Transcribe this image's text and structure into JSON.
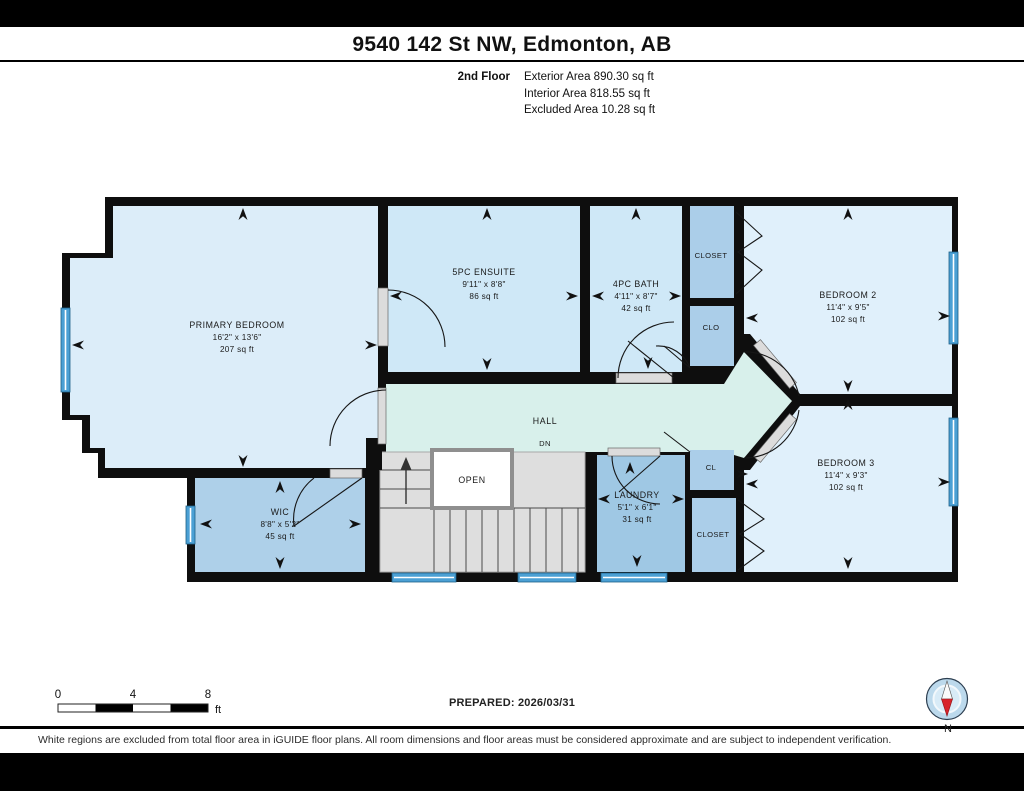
{
  "header": {
    "title": "9540 142 St NW, Edmonton, AB",
    "floor_label": "2nd Floor",
    "stats": [
      "Exterior Area 890.30 sq ft",
      "Interior Area 818.55 sq ft",
      "Excluded Area 10.28 sq ft"
    ]
  },
  "plan": {
    "rooms": [
      {
        "name": "PRIMARY BEDROOM",
        "dims": "16'2\" x 13'6\"",
        "area": "207 sq ft"
      },
      {
        "name": "5PC ENSUITE",
        "dims": "9'11\" x 8'8\"",
        "area": "86 sq ft"
      },
      {
        "name": "4PC BATH",
        "dims": "4'11\" x 8'7\"",
        "area": "42 sq ft"
      },
      {
        "name": "BEDROOM 2",
        "dims": "11'4\" x 9'5\"",
        "area": "102 sq ft"
      },
      {
        "name": "BEDROOM 3",
        "dims": "11'4\" x 9'3\"",
        "area": "102 sq ft"
      },
      {
        "name": "WIC",
        "dims": "8'8\" x 5'2\"",
        "area": "45 sq ft"
      },
      {
        "name": "LAUNDRY",
        "dims": "5'1\" x 6'1\"",
        "area": "31 sq ft"
      }
    ],
    "labels": {
      "closet_top": "CLOSET",
      "clo": "CLO",
      "cl": "CL",
      "closet_b3": "CLOSET",
      "hall": "HALL",
      "dn": "DN",
      "open": "OPEN"
    }
  },
  "footer": {
    "scale": {
      "t0": "0",
      "t4": "4",
      "t8": "8",
      "unit": "ft"
    },
    "prepared": "PREPARED: 2026/03/31",
    "compass_n": "N",
    "disclaimer": "White regions are excluded from total floor area in iGUIDE floor plans. All room dimensions and floor areas must be considered approximate and are subject to independent verification."
  },
  "colors": {
    "wall": "#0e0e0e",
    "bedroom_fill": "#e0f0fb",
    "bath_fill": "#cfe8f7",
    "closet_fill": "#abcee9",
    "laundry_fill": "#9fc8e4",
    "hall_fill": "#d8f0eb",
    "stairs_fill": "#dedede",
    "window_blue": "#4ba0d4",
    "compass_red": "#d8232a"
  }
}
